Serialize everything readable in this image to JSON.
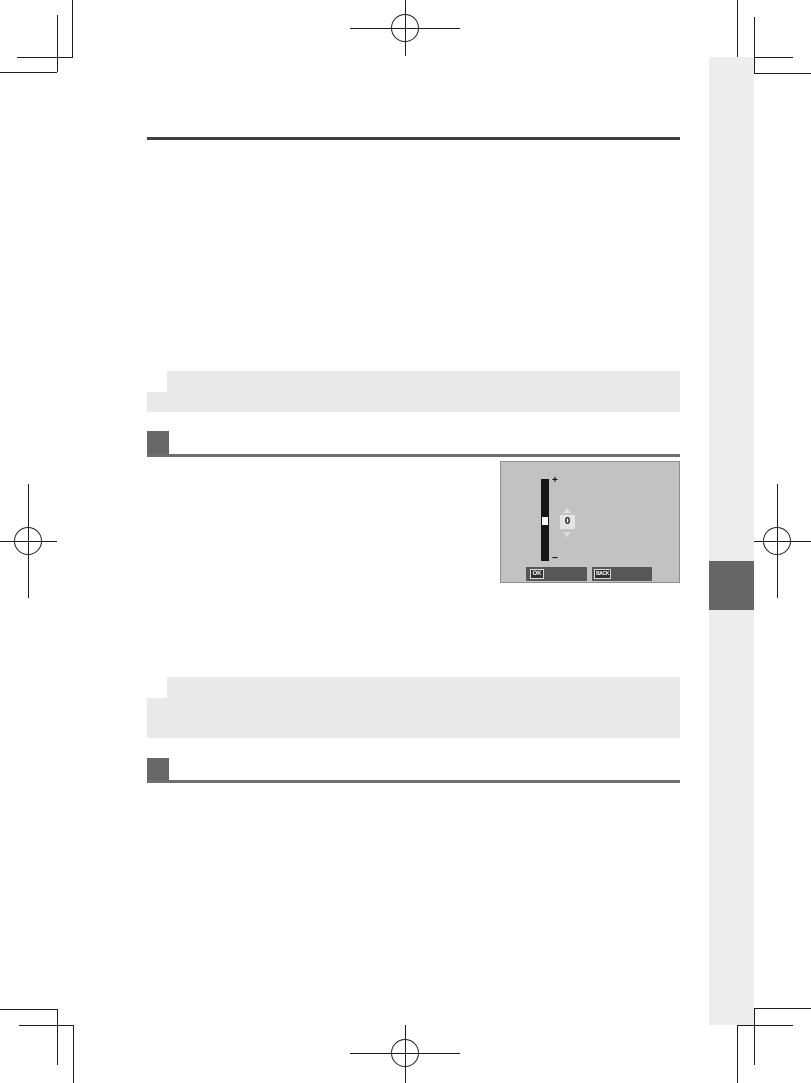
{
  "page": {
    "kind": "camera-operating-manual-print-proof",
    "background": "#ffffff",
    "content_area": {
      "left": 147,
      "right": 680
    }
  },
  "colors": {
    "rule_dark": "#3e3e3e",
    "step_gray": "#676767",
    "note_box_gray": "#e9e9e9",
    "side_band_gray": "#ededed",
    "side_tab_gray": "#666666",
    "lcd_background": "#c2c2c2",
    "lcd_bar": "#575757",
    "slider_black": "#161616"
  },
  "print_marks": {
    "corner_crop_marks": 4,
    "registration_marks": [
      "top-center",
      "left-middle",
      "right-middle",
      "bottom-center"
    ]
  },
  "notes": [
    {
      "style": "memo-box",
      "text": ""
    },
    {
      "style": "memo-box",
      "text": ""
    }
  ],
  "steps": [
    {
      "number_box": "",
      "heading": ""
    },
    {
      "number_box": "",
      "heading": ""
    }
  ],
  "illustration": {
    "type": "camera-lcd-brightness-adjust-screen",
    "slider_value": "0",
    "increase_icon": "+",
    "decrease_icon": "−",
    "buttons": [
      {
        "label": "OK"
      },
      {
        "label": "BACK"
      }
    ]
  }
}
